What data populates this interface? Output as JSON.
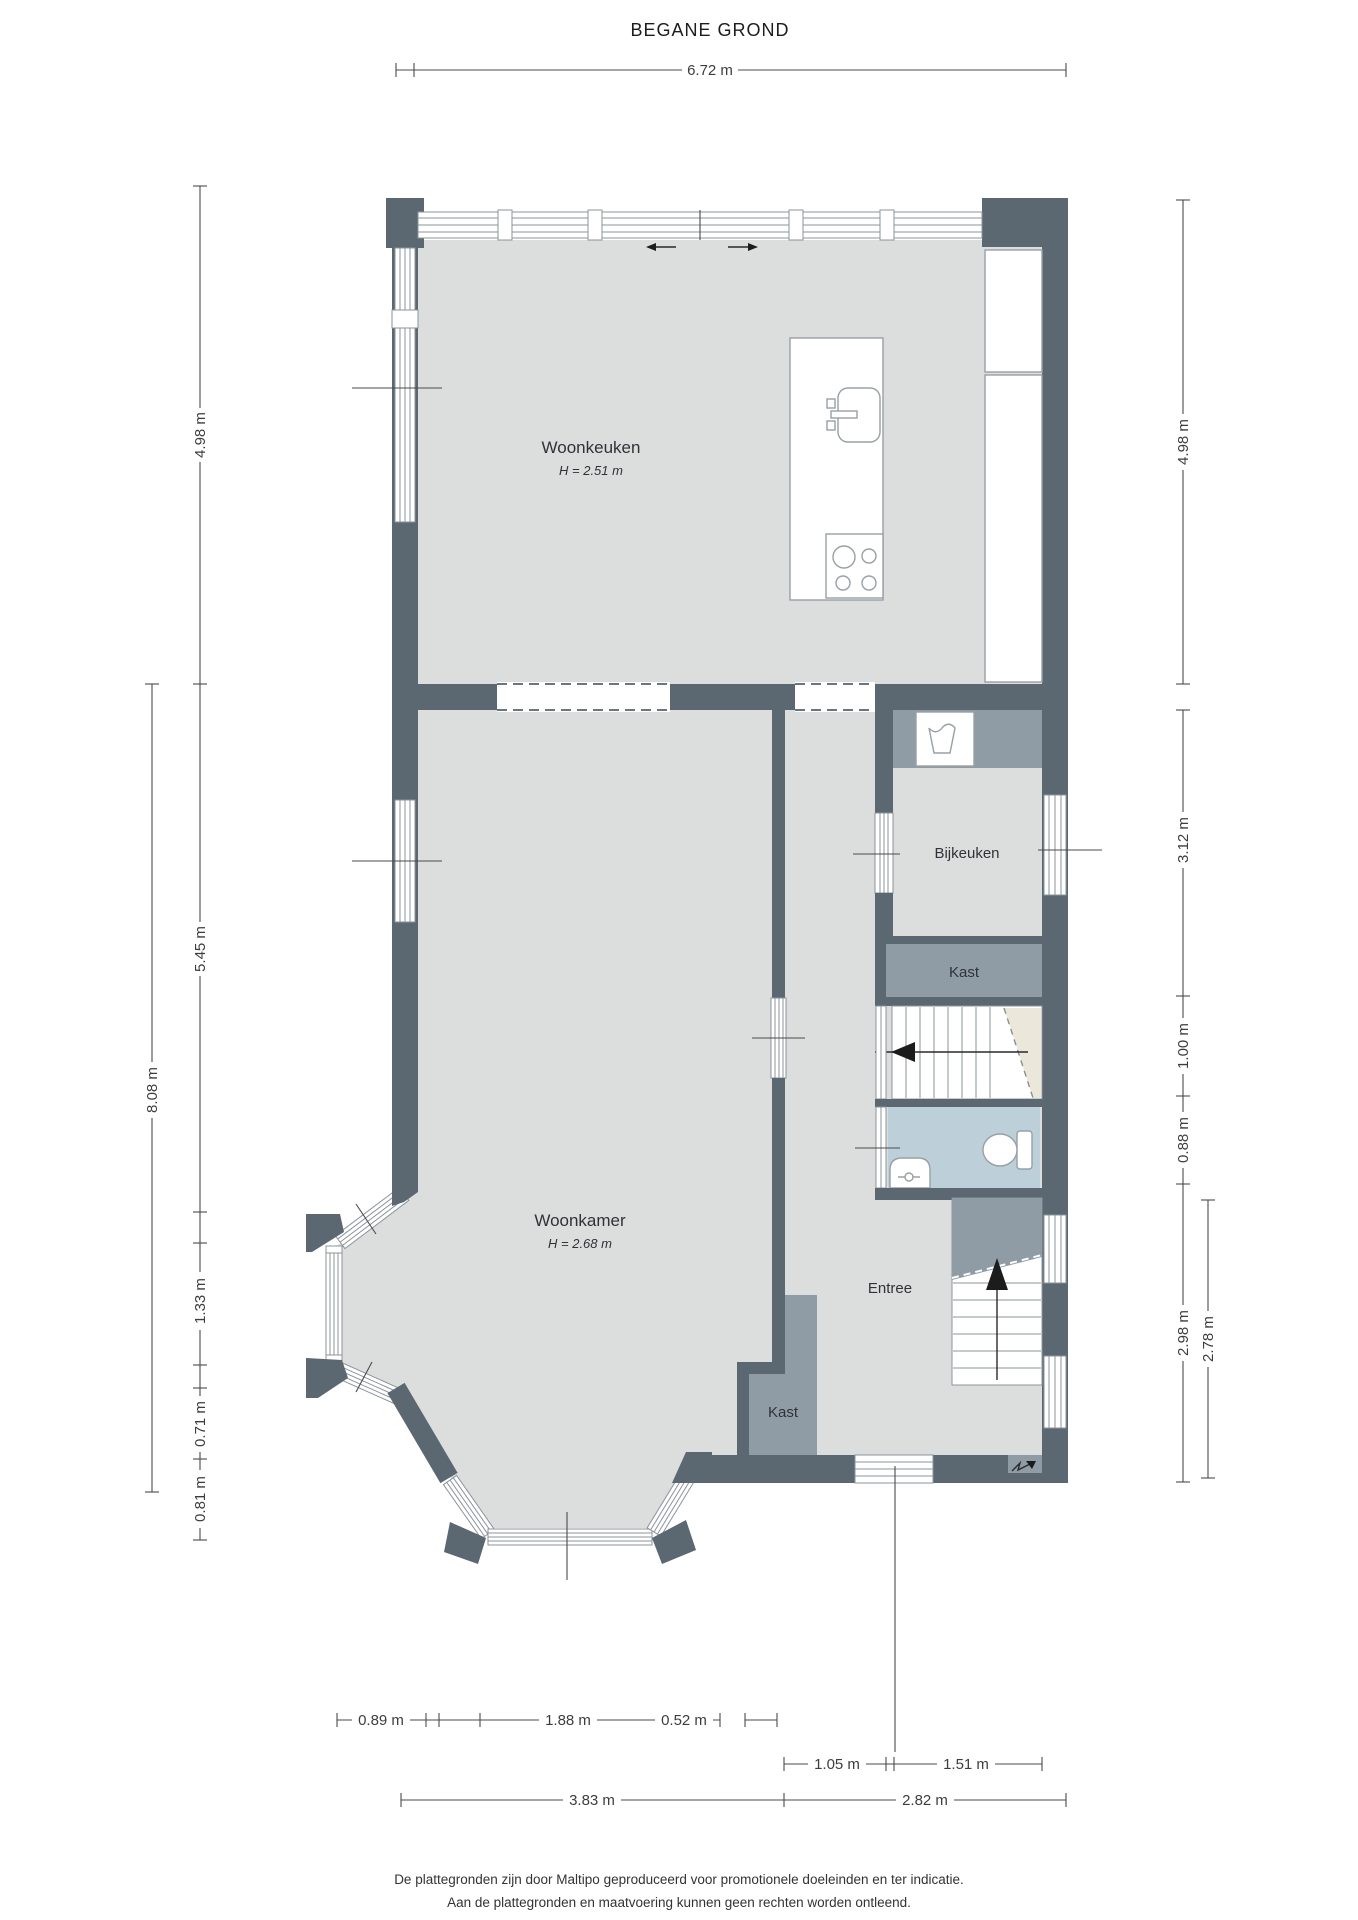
{
  "title": "BEGANE GROND",
  "rooms": {
    "woonkeuken": {
      "label": "Woonkeuken",
      "height": "H = 2.51 m"
    },
    "woonkamer": {
      "label": "Woonkamer",
      "height": "H = 2.68 m"
    },
    "bijkeuken": {
      "label": "Bijkeuken"
    },
    "kast_boven": {
      "label": "Kast"
    },
    "kast_entree": {
      "label": "Kast"
    },
    "entree": {
      "label": "Entree"
    }
  },
  "dimensions": {
    "top": {
      "width": "6.72 m"
    },
    "left": {
      "total": "8.08 m",
      "keuken": "4.98 m",
      "woonkamer": "5.45 m",
      "erker_zijde": "1.33 m",
      "erker_hoek1": "0.71 m",
      "erker_hoek2": "0.81 m"
    },
    "right": {
      "keuken": "4.98 m",
      "bijkeuken": "3.12 m",
      "trap": "1.00 m",
      "toilet": "0.88 m",
      "entree": "2.98 m",
      "entree_binnen": "2.78 m"
    },
    "bottom": {
      "row1": [
        "0.89 m",
        "1.88 m",
        "0.52 m"
      ],
      "row2": [
        "1.05 m",
        "1.51 m"
      ],
      "row3": [
        "3.83 m",
        "2.82 m"
      ]
    }
  },
  "footer": {
    "line1": "De plattegronden zijn door Maltipo geproduceerd voor promotionele doeleinden en ter indicatie.",
    "line2": "Aan de plattegronden en maatvoering kunnen geen rechten worden ontleend.",
    "line3": "© maltipo.nl"
  },
  "icons": {
    "sink": "sink-icon",
    "stove": "stove-icon",
    "washing_machine": "washing-machine-icon",
    "toilet": "toilet-icon",
    "basin": "basin-icon",
    "stairs_up": "stairs-up-arrow-icon",
    "stairs_direction": "stairs-direction-arrow-icon",
    "entry": "entry-arrow-icon",
    "sliding_door": "sliding-door-arrows-icon"
  },
  "colors": {
    "wall": "#5b6771",
    "floor": "#dcdddd",
    "cabinet": "#8f9ca6",
    "toilet_floor": "#bdd0d9",
    "stair_wedge": "#ece7db",
    "outline": "#8b949b"
  }
}
